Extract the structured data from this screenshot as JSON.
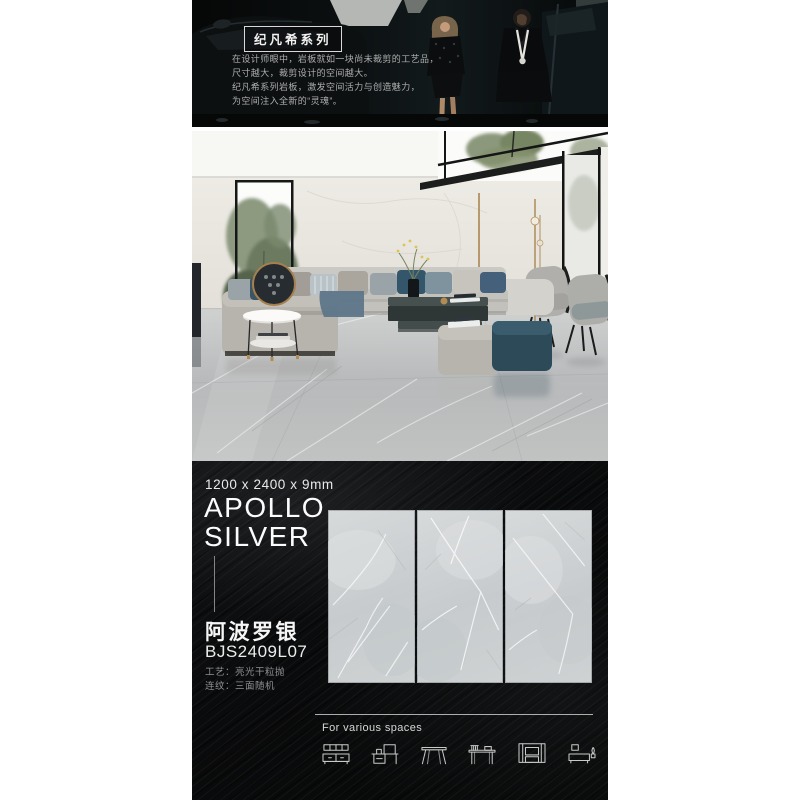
{
  "banner": {
    "series_title": "纪凡希系列",
    "lines": [
      "在设计师眼中，岩板就如一块尚未裁剪的工艺品，",
      "尺寸越大，裁剪设计的空间越大。",
      "纪凡希系列岩板，激发空间活力与创造魅力，",
      "为空间注入全新的“灵魂”。"
    ]
  },
  "product": {
    "dimensions": "1200 x 2400 x 9mm",
    "name_en_line1": "APOLLO",
    "name_en_line2": "SILVER",
    "name_cn": "阿波罗银",
    "sku": "BJS2409L07",
    "specs": [
      "工艺：亮光干粒抛",
      "连纹：三面随机"
    ]
  },
  "footer": {
    "caption": "For various spaces",
    "icons": [
      "sideboard-icon",
      "dresser-desk-icon",
      "dining-table-icon",
      "writing-desk-icon",
      "media-wall-icon",
      "tv-cabinet-icon"
    ]
  },
  "colors": {
    "page_background": "#ffffff",
    "section_black": "#0a0b0c",
    "tile_marble": "#cdd1d2",
    "floor_marble": "#b8babb",
    "wall_marble": "#eceae5",
    "ottoman_teal": "#2d4a59",
    "accent_brass": "#a9854f",
    "text_light": "#f5f5f5",
    "text_dim": "#8f9193"
  }
}
